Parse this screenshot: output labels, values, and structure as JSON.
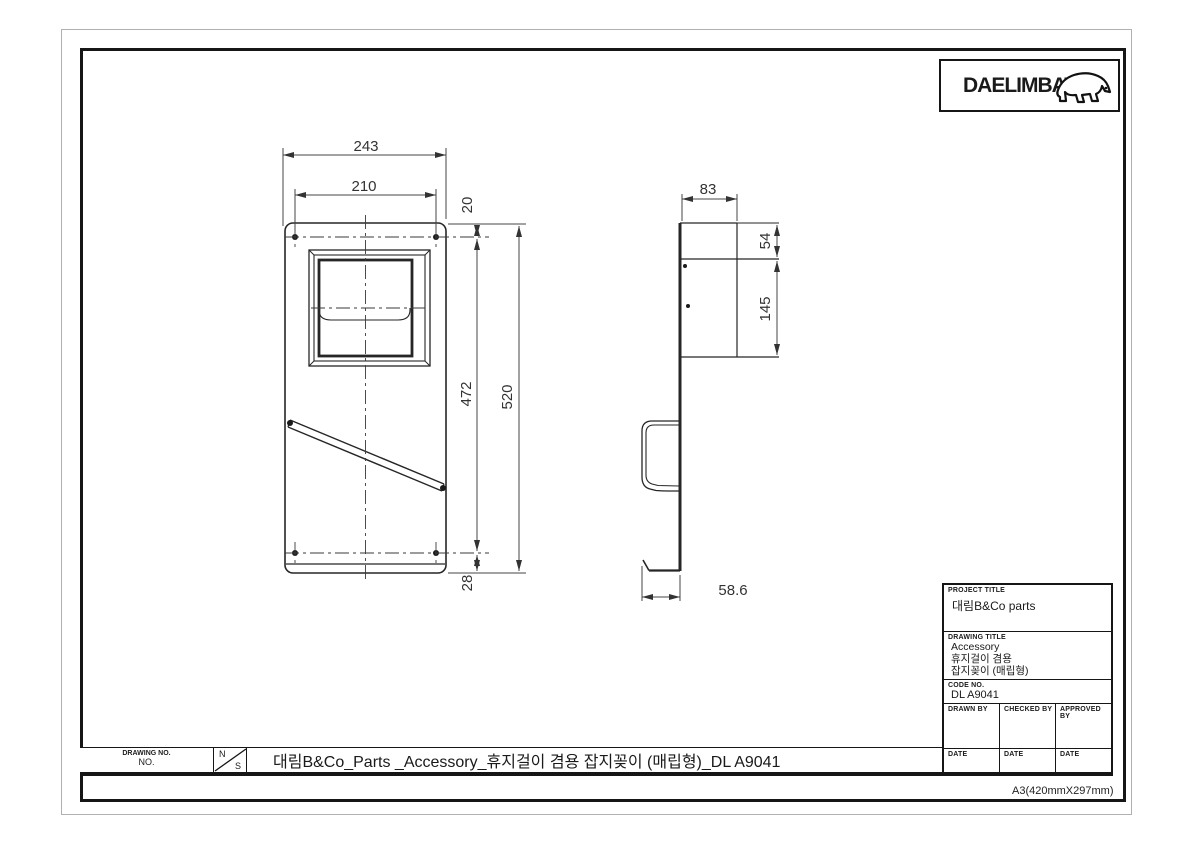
{
  "logo": {
    "brand": "DAELIMBATH"
  },
  "views": {
    "front": {
      "dims": {
        "overall_width": "243",
        "hole_spacing_h": "210",
        "top_offset": "20",
        "hole_spacing_v": "472",
        "overall_height": "520",
        "bottom_offset": "28"
      }
    },
    "side": {
      "dims": {
        "depth": "83",
        "recess_top": "54",
        "recess_height": "145",
        "lip_depth": "58.6"
      }
    }
  },
  "title_block": {
    "project_title_label": "PROJECT TITLE",
    "project_title": "대림B&Co parts",
    "drawing_title_label": "DRAWING TITLE",
    "drawing_title_lines": [
      "Accessory",
      "휴지걸이 겸용",
      "잡지꽂이 (매립형)"
    ],
    "code_no_label": "CODE NO.",
    "code_no": "DL A9041",
    "drawn_by_label": "DRAWN BY",
    "checked_by_label": "CHECKED BY",
    "approved_by_label": "APPROVED BY",
    "date_label": "DATE",
    "paper_size": "A3(420mmX297mm)"
  },
  "bottom_bar": {
    "drawing_no_label": "DRAWING NO.",
    "no_label": "NO.",
    "scale_n": "N",
    "scale_s": "S",
    "title": "대림B&Co_Parts _Accessory_휴지걸이 겸용 잡지꽂이 (매립형)_DL A9041"
  }
}
